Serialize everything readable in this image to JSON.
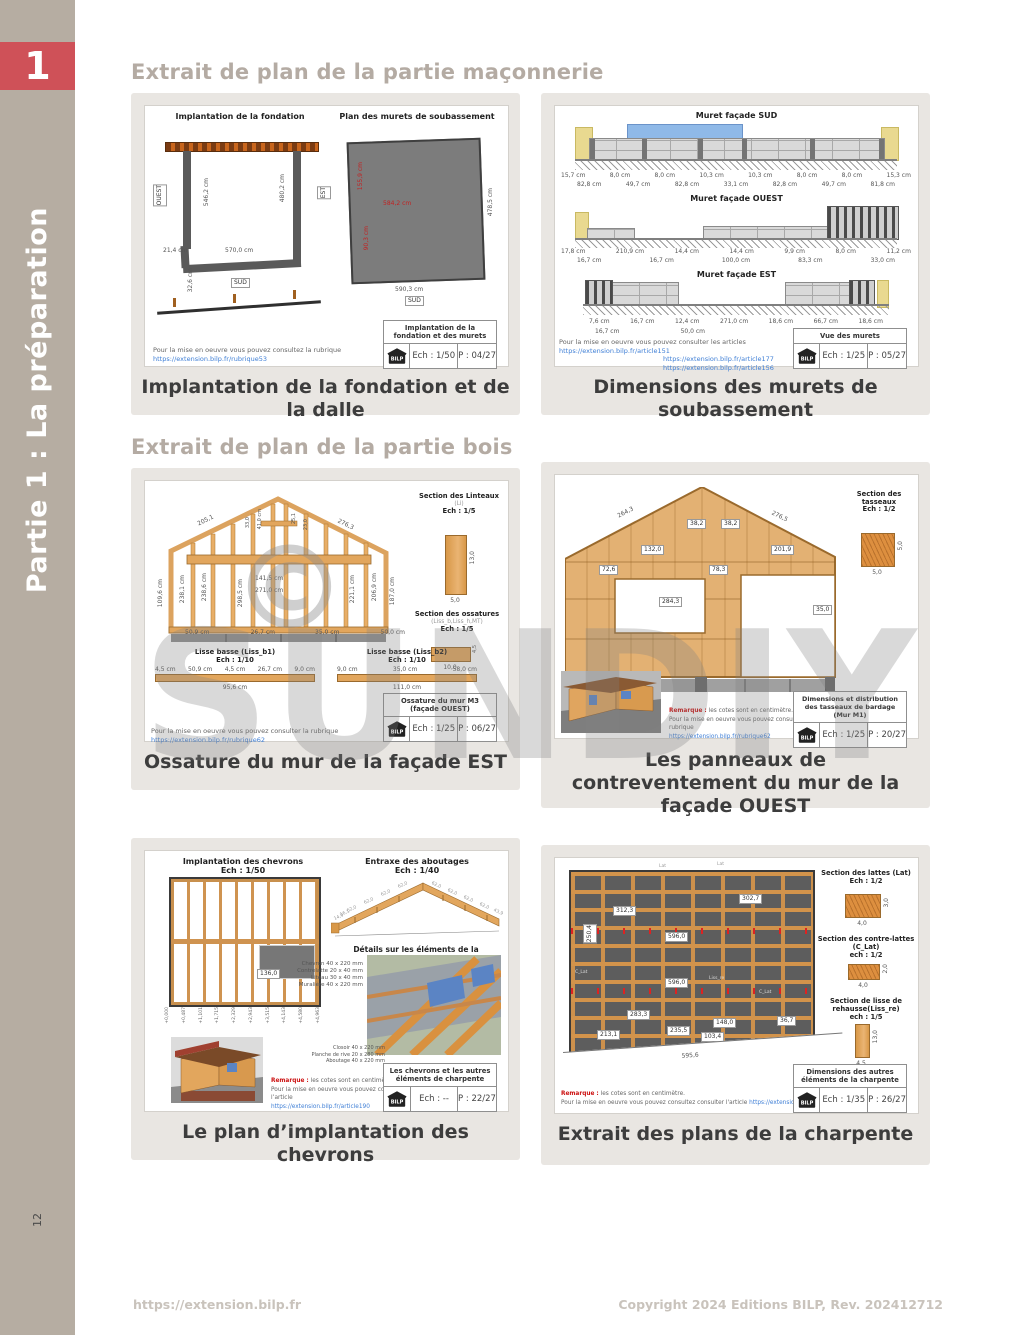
{
  "logo": {
    "text": "BILP"
  },
  "sidebar": {
    "part_number": "1",
    "part_title": "Partie 1 : La préparation",
    "page_number": "12"
  },
  "headings": {
    "masonry": "Extrait de plan de la partie maçonnerie",
    "wood": "Extrait de plan de la partie bois"
  },
  "watermark": {
    "text": "SUNDIY",
    "symbol": "©"
  },
  "footer": {
    "url": "https://extension.bilp.fr",
    "copyright": "Copyright 2024 Editions BILP, Rev. 202412712"
  },
  "p1": {
    "caption": "Implantation de la fondation et de la dalle",
    "left_title": "Implantation de la fondation",
    "right_title": "Plan des murets de soubassement",
    "dims": {
      "west": "OUEST",
      "east": "EST",
      "sud1": "SUD",
      "sud2": "SUD",
      "w1": "21,4 cm",
      "w2": "570,0 cm",
      "h1": "546,2 cm",
      "h2": "480,2 cm",
      "h3": "32,6 cm",
      "r1": "584,2 cm",
      "r2": "155,9 cm",
      "r3": "90,3 cm",
      "r4": "478,5 cm",
      "r5": "590,3 cm"
    },
    "note": "Pour la mise en oeuvre vous pouvez consultez la rubrique",
    "link": "https://extension.bilp.fr/rubrique53",
    "box": {
      "title": "Implantation de la fondation et des murets",
      "ech": "Ech : 1/50",
      "page": "P : 04/27"
    }
  },
  "p2": {
    "caption": "Dimensions des murets de soubassement",
    "sud": {
      "title": "Muret façade SUD",
      "dims1": [
        "15,7 cm",
        "8,0 cm",
        "8,0 cm",
        "10,3 cm",
        "10,3 cm",
        "8,0 cm",
        "8,0 cm",
        "15,3 cm"
      ],
      "dims2": [
        "82,8 cm",
        "49,7 cm",
        "82,8 cm",
        "33,1 cm",
        "82,8 cm",
        "49,7 cm",
        "81,8 cm"
      ]
    },
    "ouest": {
      "title": "Muret façade OUEST",
      "dims1": [
        "17,8 cm",
        "210,9 cm",
        "14,4 cm",
        "14,4 cm",
        "9,9 cm",
        "8,0 cm",
        "11,2 cm"
      ],
      "dims2": [
        "16,7 cm",
        "16,7 cm",
        "100,0 cm",
        "83,3 cm",
        "33,0 cm"
      ]
    },
    "est": {
      "title": "Muret façade EST",
      "dims1": [
        "7,6 cm",
        "16,7 cm",
        "12,4 cm",
        "271,0 cm",
        "18,6 cm",
        "66,7 cm",
        "18,6 cm"
      ],
      "dims2": [
        "16,7 cm",
        "50,0 cm"
      ]
    },
    "note": "Pour la mise en oeuvre vous pouvez consulter les articles",
    "links": [
      "https://extension.bilp.fr/article151",
      "https://extension.bilp.fr/article177",
      "https://extension.bilp.fr/article156"
    ],
    "box": {
      "title": "Vue des murets",
      "ech": "Ech : 1/25",
      "page": "P : 05/27"
    }
  },
  "p3": {
    "caption": "Ossature du mur de la façade EST",
    "slope_left": "205,1",
    "slope_right": "276,3",
    "lintel_dim1": "141,5 cm",
    "lintel_dim2": "271,0 cm",
    "vert_dims": [
      "109,6 cm",
      "238,1 cm",
      "238,6 cm",
      "298,5 cm",
      "221,1 cm",
      "206,9 cm",
      "187,0 cm"
    ],
    "apex_dims": [
      "33,0",
      "41,0 cm",
      "25,1",
      "23,0"
    ],
    "base_dims_left": [
      "50,9 cm",
      "26,7 cm"
    ],
    "base_dims_right": [
      "35,0 cm",
      "50,0 cm"
    ],
    "sec1": {
      "title": "Section des Linteaux",
      "sub": "(Li)",
      "ech": "Ech : 1/5",
      "d1": "13,0",
      "d2": "5,0"
    },
    "sec2": {
      "title": "Section des ossatures",
      "sub": "(Liss_b,Liss_h,MT)",
      "ech": "Ech : 1/5",
      "d1": "4,5",
      "d2": "10,0"
    },
    "lisse1": {
      "title": "Lisse basse (Liss_b1)",
      "ech": "Ech : 1/10",
      "dims": [
        "4,5 cm",
        "50,9 cm",
        "4,5 cm",
        "26,7 cm",
        "9,0 cm"
      ],
      "total": "95,6 cm"
    },
    "lisse2": {
      "title": "Lisse basse (Liss_b2)",
      "ech": "Ech : 1/10",
      "dims": [
        "9,0 cm",
        "35,0 cm",
        "58,0 cm"
      ],
      "total": "111,0 cm"
    },
    "note": "Pour la mise en oeuvre vous pouvez consulter la rubrique",
    "link": "https://extension.bilp.fr/rubrique62",
    "box": {
      "title": "Ossature du mur M3",
      "title2": "(façade OUEST)",
      "ech": "Ech : 1/25",
      "page": "P : 06/27"
    }
  },
  "p4": {
    "caption": "Les panneaux de contreventement du mur de la façade OUEST",
    "slope_left": "264,3",
    "slope_right": "276,5",
    "tags": [
      "38,2",
      "38,2",
      "132,0",
      "201,9",
      "72,6",
      "78,3",
      "284,3",
      "35,0"
    ],
    "sec": {
      "title": "Section des tasseaux",
      "ech": "Ech : 1/2",
      "d1": "5,0",
      "d2": "5,0"
    },
    "remark_label": "Remarque :",
    "remark": "les cotes sont en centimètre.",
    "note": "Pour la mise en oeuvre vous pouvez consulter la rubrique",
    "link": "https://extension.bilp.fr/rubrique62",
    "box": {
      "title": "Dimensions et distribution des tasseaux de bardage (Mur M1)",
      "ech": "Ech : 1/25",
      "page": "P : 20/27"
    }
  },
  "p5": {
    "caption": "Le plan d’implantation des chevrons",
    "left_title": "Implantation des chevrons",
    "left_ech": "Ech : 1/50",
    "right_title": "Entraxe des aboutages",
    "right_ech": "Ech : 1/40",
    "entraxe": [
      "14,9",
      "16,1",
      "62,0",
      "62,0",
      "62,0",
      "62,0",
      "62,0",
      "62,0",
      "62,0",
      "62,0",
      "43,9"
    ],
    "plan_tag": "136,0",
    "levels": [
      "+0,000",
      "+0,487",
      "+1,101",
      "+1,715",
      "+2,329",
      "+2,943",
      "+3,515",
      "+4,143",
      "+4,580",
      "+4,963"
    ],
    "detail_title": "Détails sur les éléments de la charpente",
    "detail_items": [
      "Chevron 40 x 220 mm",
      "Contrelatte 20 x 40 mm",
      "Liteau 30 x 40 mm",
      "Muralière 40 x 220 mm"
    ],
    "detail_items2": [
      "Closoir 40 x 220 mm",
      "Planche de rive 20 x 280 mm",
      "Aboutage 40 x 220 mm"
    ],
    "remark_label": "Remarque :",
    "remark": "les cotes sont en centimètre.",
    "note": "Pour la mise en oeuvre vous pouvez consulter l’article",
    "link": "https://extension.bilp.fr/article190",
    "box": {
      "title": "Les chevrons et les autres éléments de charpente",
      "ech": "Ech : --",
      "page": "P : 22/27"
    }
  },
  "p6": {
    "caption": "Extrait des plans de la charpente",
    "tags": [
      "312,3",
      "596,0",
      "302,7",
      "250,4",
      "596,0",
      "283,3",
      "148,0",
      "213,1",
      "235,5",
      "36,7",
      "103,4"
    ],
    "bottom_dim": "595,6",
    "callouts": [
      "Lat",
      "Lat",
      "C_Lat",
      "Liss_re",
      "C_Lat"
    ],
    "sec1": {
      "title": "Section des lattes (Lat)",
      "ech": "Ech : 1/2",
      "d1": "3,0",
      "d2": "4,0"
    },
    "sec2": {
      "title": "Section des contre-lattes (C_Lat)",
      "ech": "ech : 1/2",
      "d1": "2,0",
      "d2": "4,0"
    },
    "sec3": {
      "title": "Section de lisse de rehausse(Liss_re)",
      "ech": "ech : 1/5",
      "d1": "13,0",
      "d2": "4,5"
    },
    "remark_label": "Remarque :",
    "remark": "les cotes sont en centimètre.",
    "note": "Pour la mise en oeuvre vous pouvez consultez consulter l'article",
    "link": "https://extension.bilp.fr/article154",
    "box": {
      "title": "Dimensions des autres éléments de la charpente",
      "ech": "Ech : 1/35",
      "page": "P : 26/27"
    }
  }
}
